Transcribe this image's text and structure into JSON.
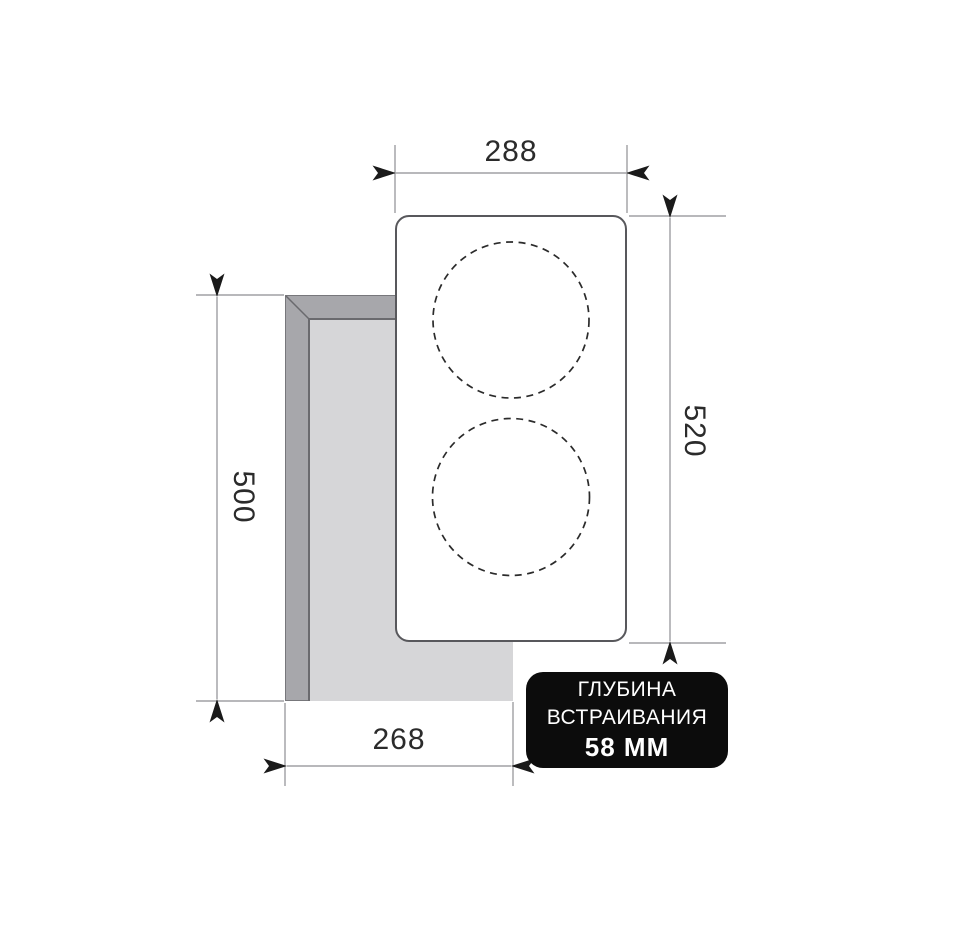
{
  "diagram": {
    "title": "cooktop-built-in-cutout-dimensions",
    "dimensions": {
      "top_width": "288",
      "right_height": "520",
      "left_height": "500",
      "bottom_width": "268"
    },
    "badge": {
      "line1": "ГЛУБИНА",
      "line2": "ВСТРАИВАНИЯ",
      "line3": "58 ММ"
    },
    "colors": {
      "background": "#ffffff",
      "cutout_side": "#a7a7ab",
      "cutout_inner": "#d6d6d8",
      "cutout_edge_line": "#6a6a6e",
      "cooktop_fill": "#ffffff",
      "cooktop_outline": "#58585c",
      "dimension_line": "#8e8e92",
      "arrowhead": "#1a1a1a",
      "dimension_text": "#2b2b2b",
      "badge_background": "#0c0c0c",
      "badge_text": "#ffffff"
    }
  }
}
